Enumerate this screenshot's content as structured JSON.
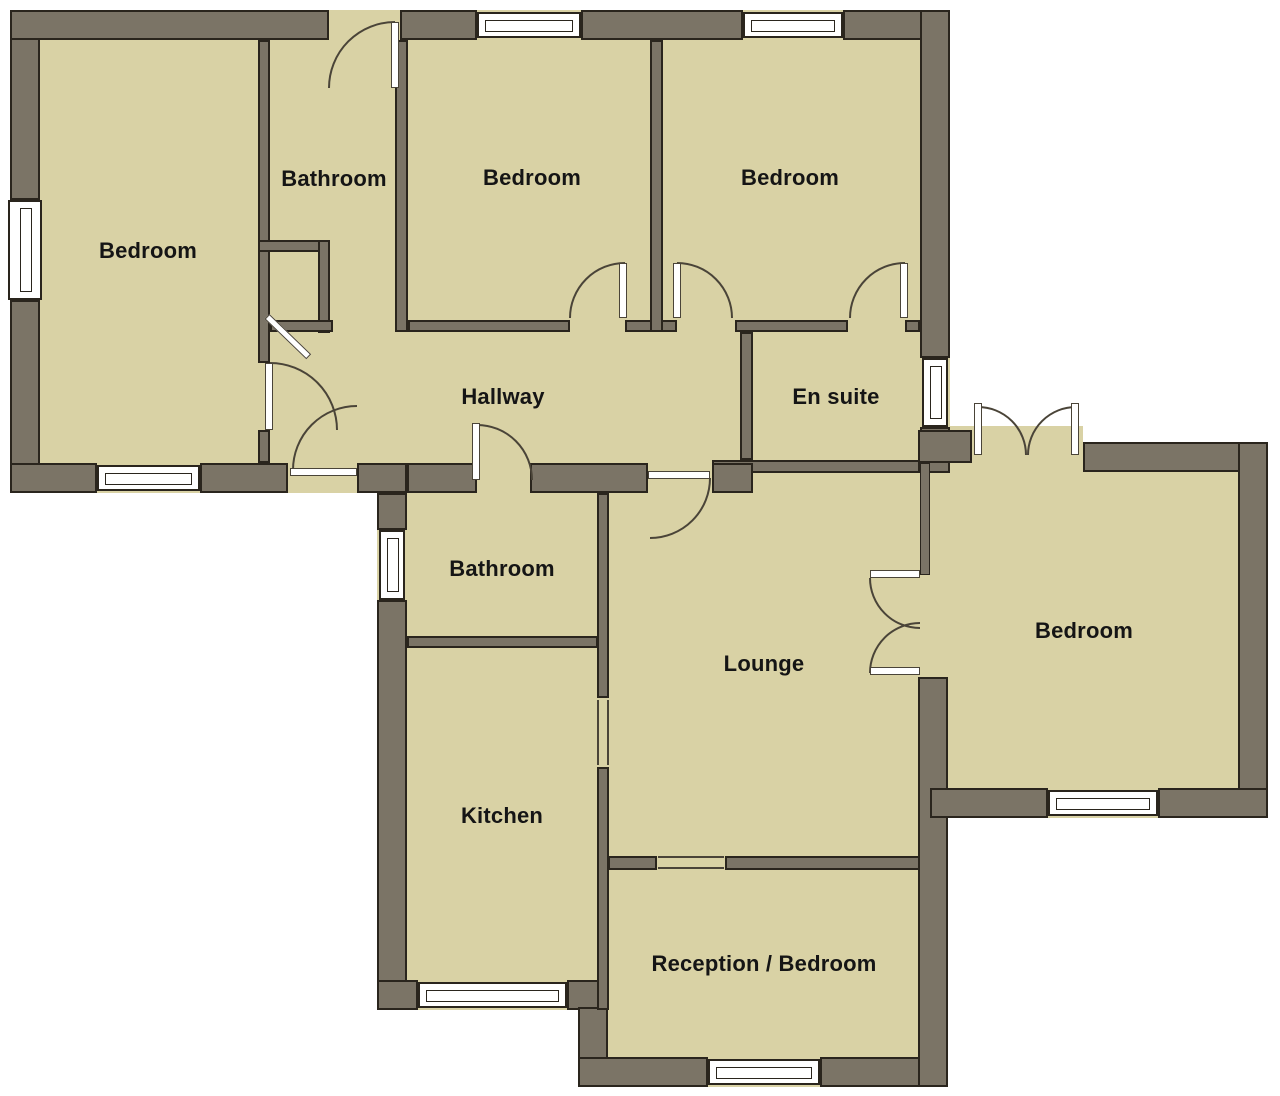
{
  "plan": {
    "colors": {
      "wall": "#7b7466",
      "floor": "#d9d2a5",
      "line": "#2a251d",
      "arc": "#4a4438"
    },
    "rooms": {
      "bedroom_top_left": {
        "label": "Bedroom"
      },
      "bathroom_top": {
        "label": "Bathroom"
      },
      "bedroom_top_middle": {
        "label": "Bedroom"
      },
      "bedroom_top_right": {
        "label": "Bedroom"
      },
      "hallway": {
        "label": "Hallway"
      },
      "en_suite": {
        "label": "En suite"
      },
      "bathroom_inner": {
        "label": "Bathroom"
      },
      "lounge": {
        "label": "Lounge"
      },
      "bedroom_right": {
        "label": "Bedroom"
      },
      "kitchen": {
        "label": "Kitchen"
      },
      "reception_bedroom": {
        "label": "Reception / Bedroom"
      }
    }
  }
}
